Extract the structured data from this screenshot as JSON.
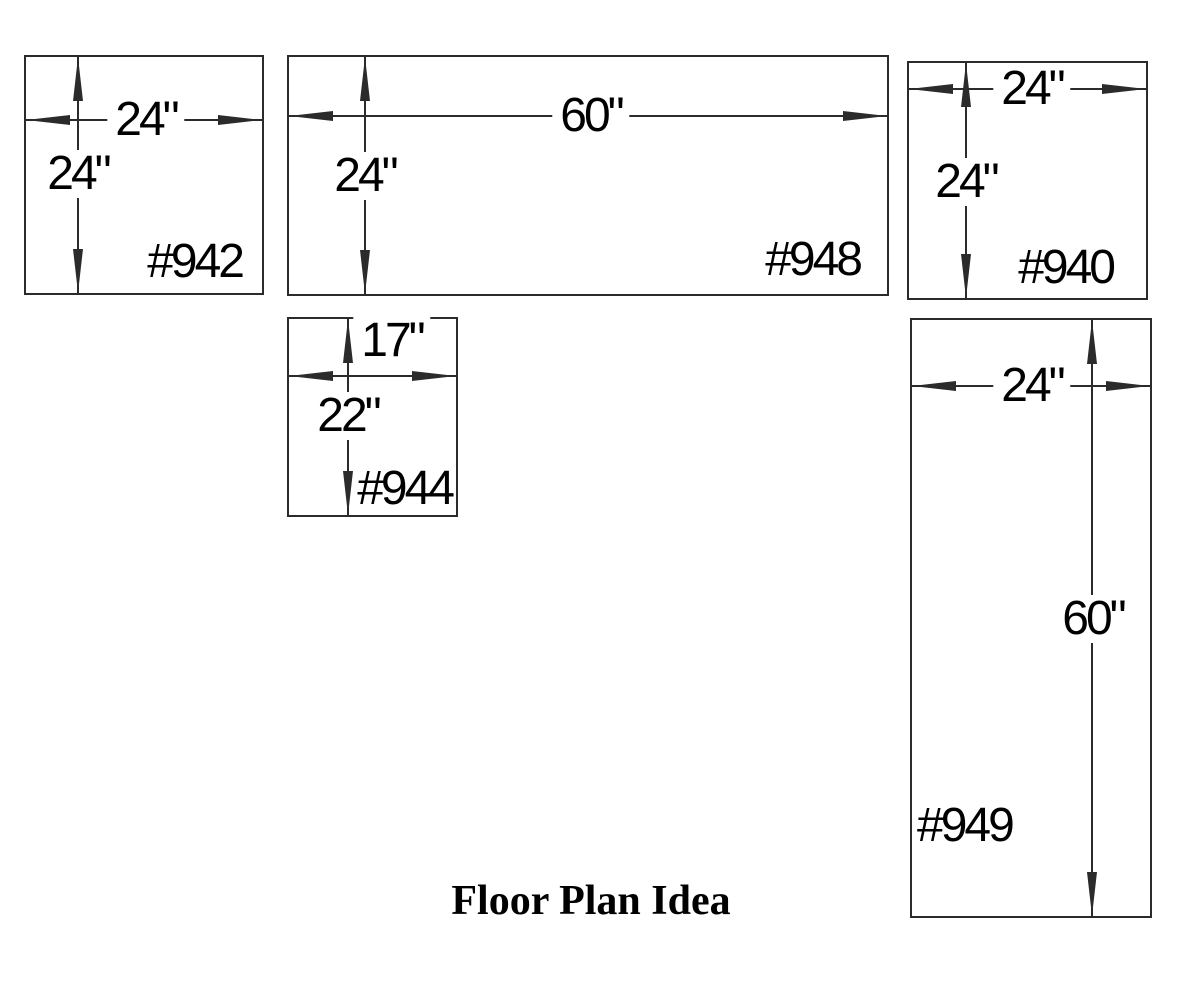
{
  "title": "Floor Plan Idea",
  "units": [
    {
      "id": "#942",
      "width": "24\"",
      "height": "24\""
    },
    {
      "id": "#948",
      "width": "60\"",
      "height": "24\""
    },
    {
      "id": "#940",
      "width": "24\"",
      "height": "24\""
    },
    {
      "id": "#944",
      "width": "17\"",
      "height": "22\""
    },
    {
      "id": "#949",
      "width": "24\"",
      "height": "60\""
    }
  ],
  "colors": {
    "line": "#2b2b2b",
    "text": "#000000",
    "background": "#ffffff"
  }
}
